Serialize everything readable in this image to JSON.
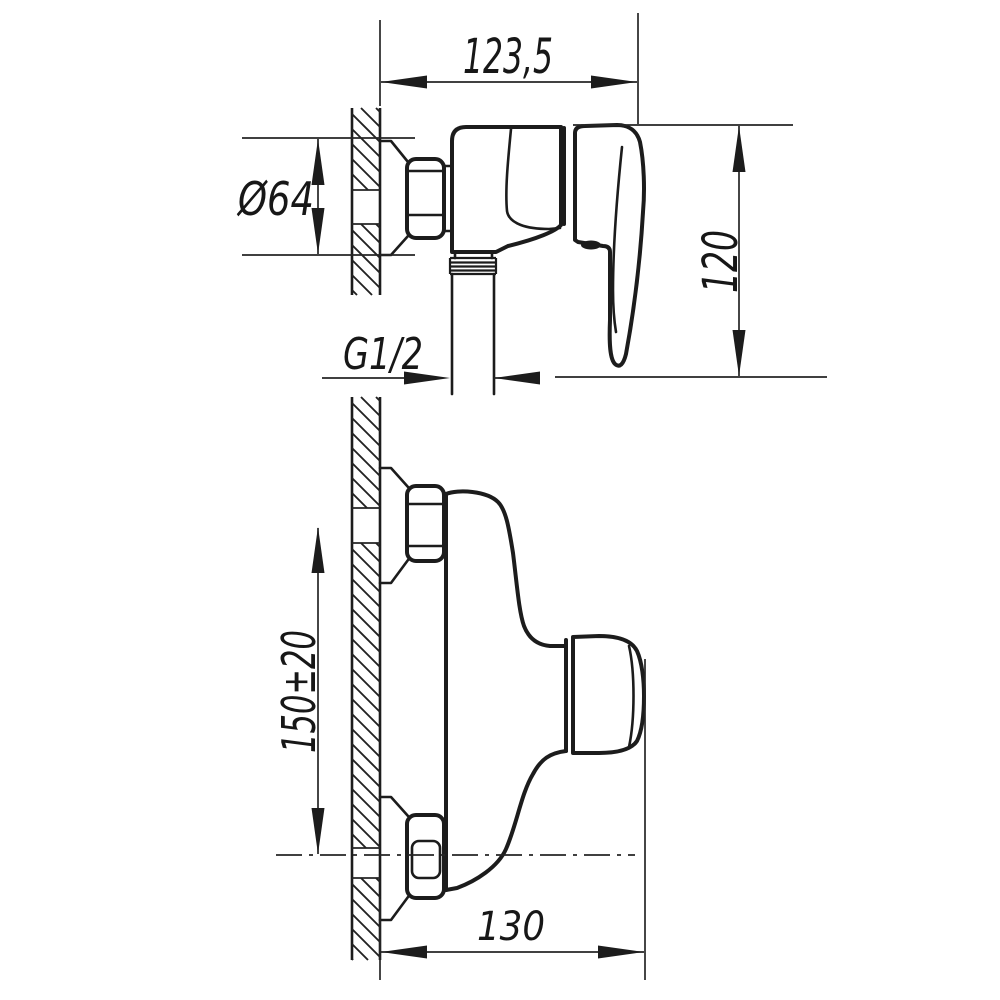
{
  "drawing": {
    "type": "technical-drawing",
    "subject": "wall-mounted single-lever shower mixer, two orthographic views",
    "background_color": "#ffffff",
    "line_color": "#1c1c1c",
    "views": {
      "side_view_label": "side view (upper drawing)",
      "plan_view_label": "plan view (lower drawing)"
    },
    "dimensions": {
      "top_width": "123,5",
      "flange_diameter": "Ø64",
      "body_height": "120",
      "thread_size": "G1/2",
      "connection_spacing": "150±20",
      "depth": "130"
    }
  }
}
